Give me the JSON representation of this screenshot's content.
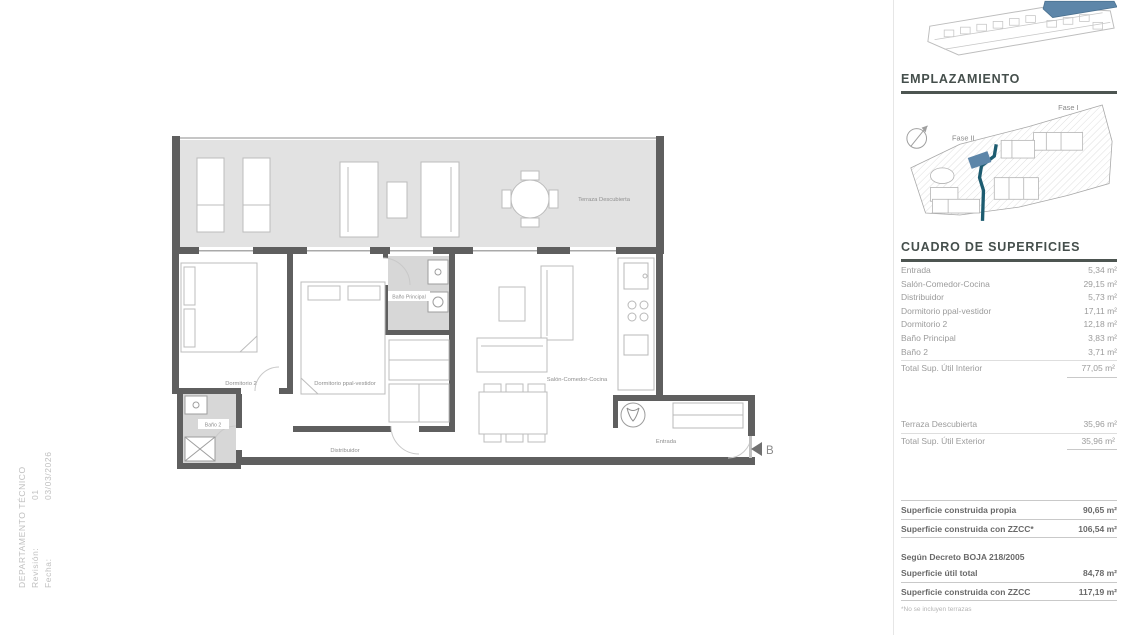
{
  "titleblock": {
    "department": "DEPARTAMENTO TÉCNICO",
    "revision_label": "Revisión:",
    "revision_value": "01",
    "date_label": "Fecha:",
    "date_value": "03/03/2026"
  },
  "plan": {
    "labels": {
      "terraza": "Terraza Descubierta",
      "dormitorio2": "Dormitorio 2",
      "dormitorio_ppal": "Dormitorio ppal-vestidor",
      "bano_principal": "Baño Principal",
      "distribuidor": "Distribuidor",
      "salon": "Salón-Comedor-Cocina",
      "entrada": "Entrada",
      "bano2": "Baño 2"
    },
    "section_marker": "B"
  },
  "emplazamiento": {
    "title": "EMPLAZAMIENTO",
    "fase_1": "Fase I",
    "fase_2": "Fase II"
  },
  "superficies": {
    "title": "CUADRO DE SUPERFICIES",
    "interior_rows": [
      {
        "label": "Entrada",
        "value": "5,34 m²"
      },
      {
        "label": "Salón-Comedor-Cocina",
        "value": "29,15 m²"
      },
      {
        "label": "Distribuidor",
        "value": "5,73 m²"
      },
      {
        "label": "Dormitorio ppal-vestidor",
        "value": "17,11 m²"
      },
      {
        "label": "Dormitorio 2",
        "value": "12,18 m²"
      },
      {
        "label": "Baño Principal",
        "value": "3,83 m²"
      },
      {
        "label": "Baño 2",
        "value": "3,71 m²"
      }
    ],
    "interior_total": {
      "label": "Total Sup. Útil Interior",
      "value": "77,05 m²"
    },
    "exterior_row": {
      "label": "Terraza Descubierta",
      "value": "35,96 m²"
    },
    "exterior_total": {
      "label": "Total Sup. Útil Exterior",
      "value": "35,96 m²"
    },
    "construida_rows": [
      {
        "label": "Superficie construida propia",
        "value": "90,65 m²"
      },
      {
        "label": "Superficie construida con ZZCC*",
        "value": "106,54 m²"
      }
    ],
    "decreto_heading": "Según Decreto BOJA 218/2005",
    "decreto_rows": [
      {
        "label": "Superficie útil total",
        "value": "84,78 m²"
      },
      {
        "label": "Superficie construida con ZZCC",
        "value": "117,19 m²"
      }
    ],
    "footnote": "*No se incluyen terrazas"
  },
  "colors": {
    "accent_teal": "#1d5c70",
    "highlight_blue": "#5d86a9",
    "wall_gray": "#5f5f5f",
    "terrace_floor": "#e2e2e2",
    "bath_floor": "#d7d7d7",
    "heading_text": "#454f4c",
    "table_text": "#9b9b9b",
    "summary_text": "#696969"
  }
}
